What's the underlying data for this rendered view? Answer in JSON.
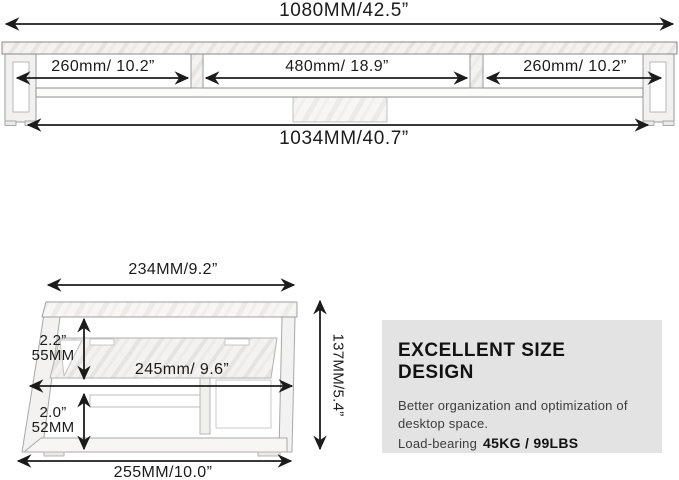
{
  "front_view": {
    "overall_width": "1080MM/42.5”",
    "left_section": "260mm/ 10.2”",
    "middle_section": "480mm/ 18.9”",
    "right_section": "260mm/ 10.2”",
    "inner_width": "1034MM/40.7”"
  },
  "side_view": {
    "top_depth": "234MM/9.2”",
    "upper_clearance_in": "2.2”",
    "upper_clearance_mm": "55MM",
    "middle_depth": "245mm/ 9.6”",
    "lower_clearance_in": "2.0”",
    "lower_clearance_mm": "52MM",
    "base_depth": "255MM/10.0”",
    "overall_height": "137MM/5.4”"
  },
  "info_box": {
    "title": "EXCELLENT SIZE DESIGN",
    "description_line1": "Better organization and optimization of",
    "description_line2": "desktop space.",
    "load_bearing_label": "Load-bearing",
    "load_bearing_value": "45KG / 99LBS"
  },
  "colors": {
    "background": "#ffffff",
    "dimension_line": "#1b1b1b",
    "furniture_outline": "#9a9a9a",
    "info_box_background": "#e3e3e3"
  }
}
